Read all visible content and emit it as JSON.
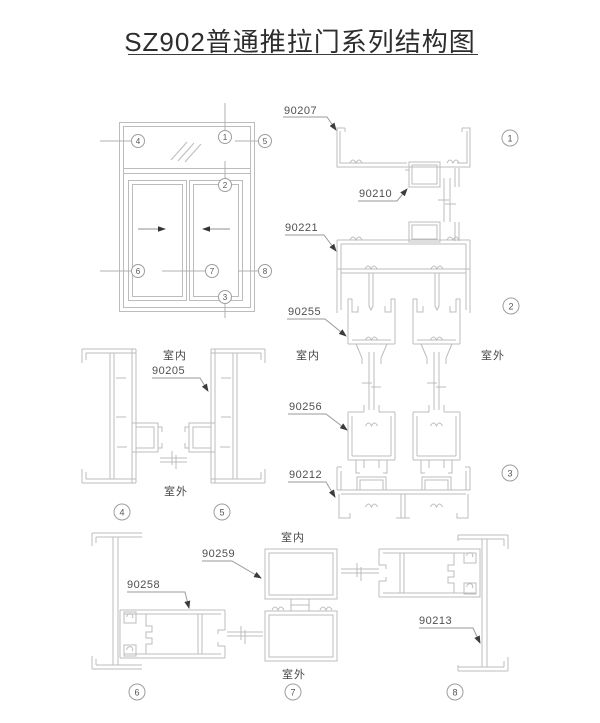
{
  "title": "SZ902普通推拉门系列结构图",
  "parts": {
    "p90207": "90207",
    "p90210": "90210",
    "p90221": "90221",
    "p90255": "90255",
    "p90256": "90256",
    "p90212": "90212",
    "p90205": "90205",
    "p90258": "90258",
    "p90259": "90259",
    "p90213": "90213"
  },
  "rooms": {
    "indoor": "室内",
    "outdoor": "室外"
  },
  "numbers": {
    "n1": "1",
    "n2": "2",
    "n3": "3",
    "n4": "4",
    "n5": "5",
    "n6": "6",
    "n7": "7",
    "n8": "8"
  },
  "colors": {
    "line": "#bcbcbc",
    "leader": "#9a9a9a",
    "arrowhead": "#3c3c3c",
    "text": "#4f4f4f",
    "title": "#2d2d2d",
    "background": "#ffffff"
  }
}
